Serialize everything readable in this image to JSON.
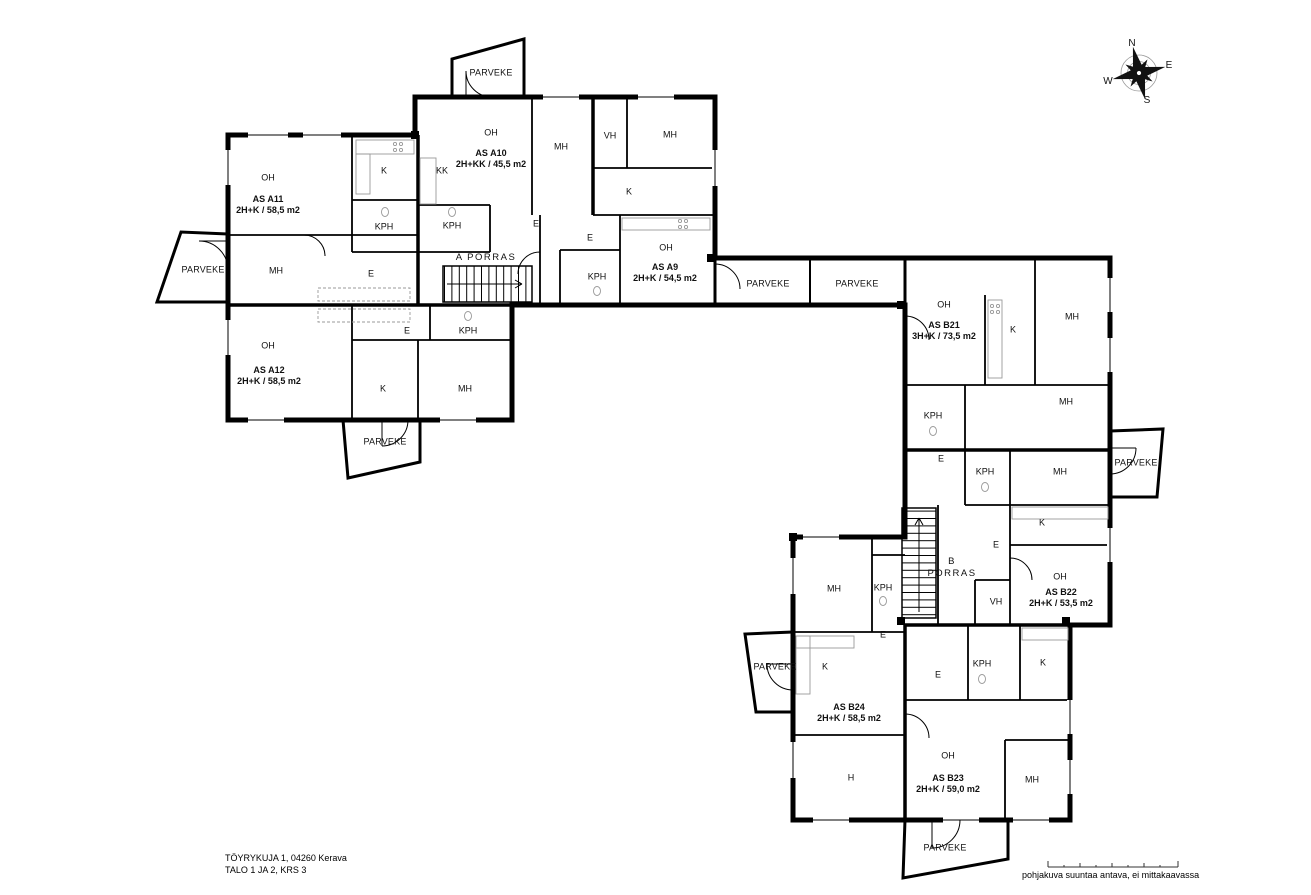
{
  "footer": {
    "address_line1": "TÖYRYKUJA 1, 04260 Kerava",
    "address_line2": "TALO 1 JA 2, KRS 3",
    "disclaimer": "pohjakuva suuntaa antava, ei mittakaavassa"
  },
  "apartments": [
    {
      "name": "apartment-label-a11",
      "text": "AS A11\n2H+K / 58,5 m2",
      "x": 268,
      "y": 205
    },
    {
      "name": "apartment-label-a10",
      "text": "AS A10\n2H+KK / 45,5 m2",
      "x": 491,
      "y": 159
    },
    {
      "name": "apartment-label-a9",
      "text": "AS A9\n2H+K / 54,5 m2",
      "x": 665,
      "y": 273
    },
    {
      "name": "apartment-label-a12",
      "text": "AS A12\n2H+K / 58,5 m2",
      "x": 269,
      "y": 376
    },
    {
      "name": "apartment-label-b21",
      "text": "AS B21\n3H+K / 73,5 m2",
      "x": 944,
      "y": 331
    },
    {
      "name": "apartment-label-b22",
      "text": "AS B22\n2H+K / 53,5 m2",
      "x": 1061,
      "y": 598
    },
    {
      "name": "apartment-label-b24",
      "text": "AS B24\n2H+K / 58,5 m2",
      "x": 849,
      "y": 713
    },
    {
      "name": "apartment-label-b23",
      "text": "AS B23\n2H+K / 59,0 m2",
      "x": 948,
      "y": 784
    }
  ],
  "rooms": [
    {
      "name": "room-label-a11-oh",
      "text": "OH",
      "x": 268,
      "y": 178
    },
    {
      "name": "room-label-a11-k",
      "text": "K",
      "x": 384,
      "y": 171
    },
    {
      "name": "room-label-a11-kph",
      "text": "KPH",
      "x": 384,
      "y": 227
    },
    {
      "name": "room-label-a11-mh",
      "text": "MH",
      "x": 276,
      "y": 271
    },
    {
      "name": "room-label-a11-e",
      "text": "E",
      "x": 371,
      "y": 274
    },
    {
      "name": "room-label-a10-oh",
      "text": "OH",
      "x": 491,
      "y": 133
    },
    {
      "name": "room-label-a10-kk",
      "text": "KK",
      "x": 442,
      "y": 171
    },
    {
      "name": "room-label-a10-kph",
      "text": "KPH",
      "x": 452,
      "y": 226
    },
    {
      "name": "room-label-a10-mh",
      "text": "MH",
      "x": 561,
      "y": 147
    },
    {
      "name": "room-label-a10-e",
      "text": "E",
      "x": 536,
      "y": 224
    },
    {
      "name": "room-label-a9-vh",
      "text": "VH",
      "x": 610,
      "y": 136
    },
    {
      "name": "room-label-a9-mh",
      "text": "MH",
      "x": 670,
      "y": 135
    },
    {
      "name": "room-label-a9-k",
      "text": "K",
      "x": 629,
      "y": 192
    },
    {
      "name": "room-label-a9-e",
      "text": "E",
      "x": 590,
      "y": 238
    },
    {
      "name": "room-label-a9-kph",
      "text": "KPH",
      "x": 597,
      "y": 277
    },
    {
      "name": "room-label-a9-oh",
      "text": "OH",
      "x": 666,
      "y": 248
    },
    {
      "name": "room-label-a12-oh",
      "text": "OH",
      "x": 268,
      "y": 346
    },
    {
      "name": "room-label-a12-e",
      "text": "E",
      "x": 407,
      "y": 331
    },
    {
      "name": "room-label-a12-kph",
      "text": "KPH",
      "x": 468,
      "y": 331
    },
    {
      "name": "room-label-a12-k",
      "text": "K",
      "x": 383,
      "y": 389
    },
    {
      "name": "room-label-a12-mh",
      "text": "MH",
      "x": 465,
      "y": 389
    },
    {
      "name": "room-label-b21-oh",
      "text": "OH",
      "x": 944,
      "y": 305
    },
    {
      "name": "room-label-b21-k",
      "text": "K",
      "x": 1013,
      "y": 330
    },
    {
      "name": "room-label-b21-mh1",
      "text": "MH",
      "x": 1072,
      "y": 317
    },
    {
      "name": "room-label-b21-kph",
      "text": "KPH",
      "x": 933,
      "y": 416
    },
    {
      "name": "room-label-b21-mh2",
      "text": "MH",
      "x": 1066,
      "y": 402
    },
    {
      "name": "room-label-b21-e",
      "text": "E",
      "x": 941,
      "y": 459
    },
    {
      "name": "room-label-b22-kph",
      "text": "KPH",
      "x": 985,
      "y": 472
    },
    {
      "name": "room-label-b22-mh",
      "text": "MH",
      "x": 1060,
      "y": 472
    },
    {
      "name": "room-label-b22-k",
      "text": "K",
      "x": 1042,
      "y": 523
    },
    {
      "name": "room-label-b22-e",
      "text": "E",
      "x": 996,
      "y": 545
    },
    {
      "name": "room-label-b22-vh",
      "text": "VH",
      "x": 996,
      "y": 602
    },
    {
      "name": "room-label-b22-oh",
      "text": "OH",
      "x": 1060,
      "y": 577
    },
    {
      "name": "room-label-b24-mh",
      "text": "MH",
      "x": 834,
      "y": 589
    },
    {
      "name": "room-label-b24-kph",
      "text": "KPH",
      "x": 883,
      "y": 588
    },
    {
      "name": "room-label-b24-e",
      "text": "E",
      "x": 883,
      "y": 635
    },
    {
      "name": "room-label-b24-k",
      "text": "K",
      "x": 825,
      "y": 667
    },
    {
      "name": "room-label-b24-h",
      "text": "H",
      "x": 851,
      "y": 778
    },
    {
      "name": "room-label-b23-e",
      "text": "E",
      "x": 938,
      "y": 675
    },
    {
      "name": "room-label-b23-kph",
      "text": "KPH",
      "x": 982,
      "y": 664
    },
    {
      "name": "room-label-b23-k",
      "text": "K",
      "x": 1043,
      "y": 663
    },
    {
      "name": "room-label-b23-oh",
      "text": "OH",
      "x": 948,
      "y": 756
    },
    {
      "name": "room-label-b23-mh",
      "text": "MH",
      "x": 1032,
      "y": 780
    }
  ],
  "balconies": [
    {
      "name": "balcony-label-a11",
      "text": "PARVEKE",
      "x": 203,
      "y": 270
    },
    {
      "name": "balcony-label-a10",
      "text": "PARVEKE",
      "x": 491,
      "y": 73
    },
    {
      "name": "balcony-label-corridor-1",
      "text": "PARVEKE",
      "x": 768,
      "y": 284
    },
    {
      "name": "balcony-label-corridor-2",
      "text": "PARVEKE",
      "x": 857,
      "y": 284
    },
    {
      "name": "balcony-label-a12",
      "text": "PARVEKE",
      "x": 385,
      "y": 442
    },
    {
      "name": "balcony-label-b21",
      "text": "PARVEKE",
      "x": 1136,
      "y": 463
    },
    {
      "name": "balcony-label-b24",
      "text": "PARVEKE",
      "x": 775,
      "y": 667
    },
    {
      "name": "balcony-label-b23",
      "text": "PARVEKE",
      "x": 945,
      "y": 848
    }
  ],
  "stairwells": [
    {
      "name": "stairwell-label-a",
      "text": "A PORRAS",
      "x": 486,
      "y": 258
    },
    {
      "name": "stairwell-label-b",
      "text": "B\nPORRAS",
      "x": 952,
      "y": 568
    }
  ],
  "compass_labels": [
    {
      "name": "compass-north",
      "text": "N",
      "x": 1132,
      "y": 44
    },
    {
      "name": "compass-east",
      "text": "E",
      "x": 1169,
      "y": 66
    },
    {
      "name": "compass-south",
      "text": "S",
      "x": 1147,
      "y": 101
    },
    {
      "name": "compass-west",
      "text": "W",
      "x": 1108,
      "y": 82
    }
  ]
}
